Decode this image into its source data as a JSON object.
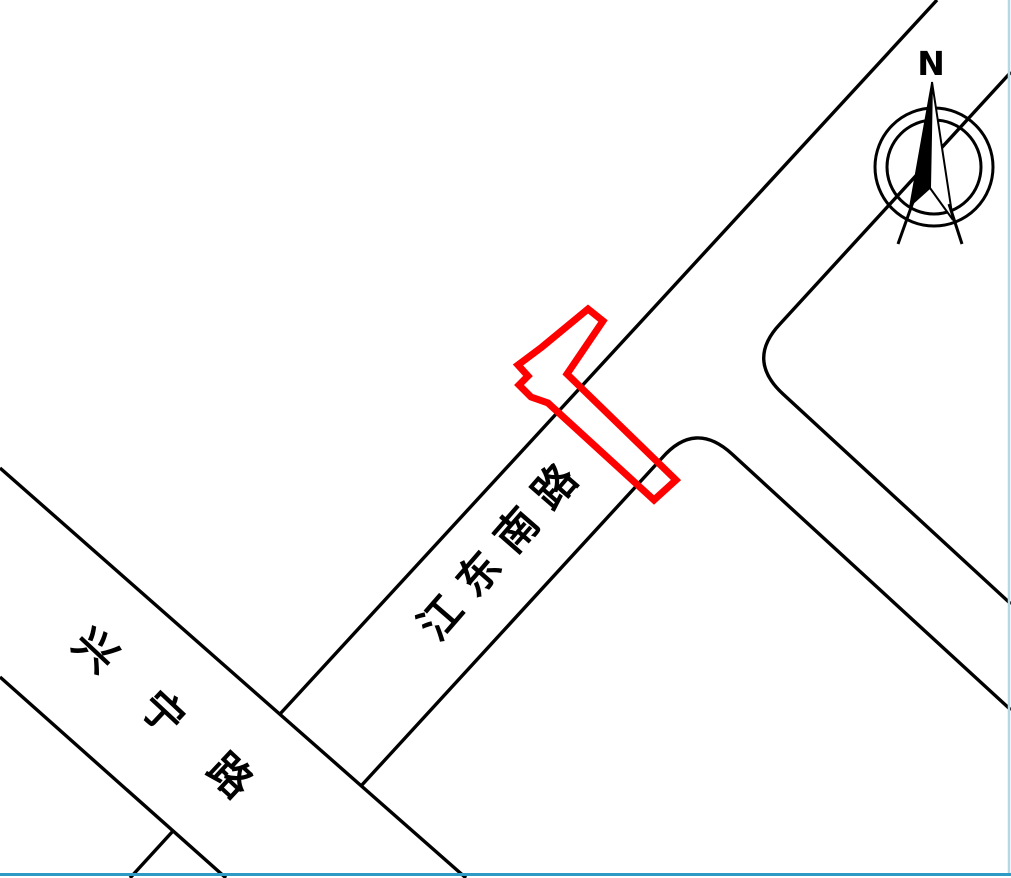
{
  "map": {
    "compass": {
      "label": "N"
    },
    "roads": {
      "jiangdong_south_road": {
        "name": "江东南路"
      },
      "xingning_road": {
        "name": "兴宁路"
      }
    },
    "geometry": {
      "road_edges": [
        "M 937 0 L 280 714",
        "M 1011 72 L 780 324 Q 746 360 783 394 L 1011 604",
        "M 361 786 L 662 458 Q 695 420 732 454 L 1011 710",
        "M 0 468 L 466 878",
        "M 0 677 L 226 878",
        "M 173 831 L 130 878"
      ]
    },
    "highlight": {
      "color": "#ff0000",
      "points": "588,309 603,321 567,374 676,480 654,500 548,403 531,397 519,385 528,376 518,365 542,347"
    },
    "borders": {
      "right_color": "#b5d8e2",
      "bottom_color": "#2d9bc3"
    }
  }
}
